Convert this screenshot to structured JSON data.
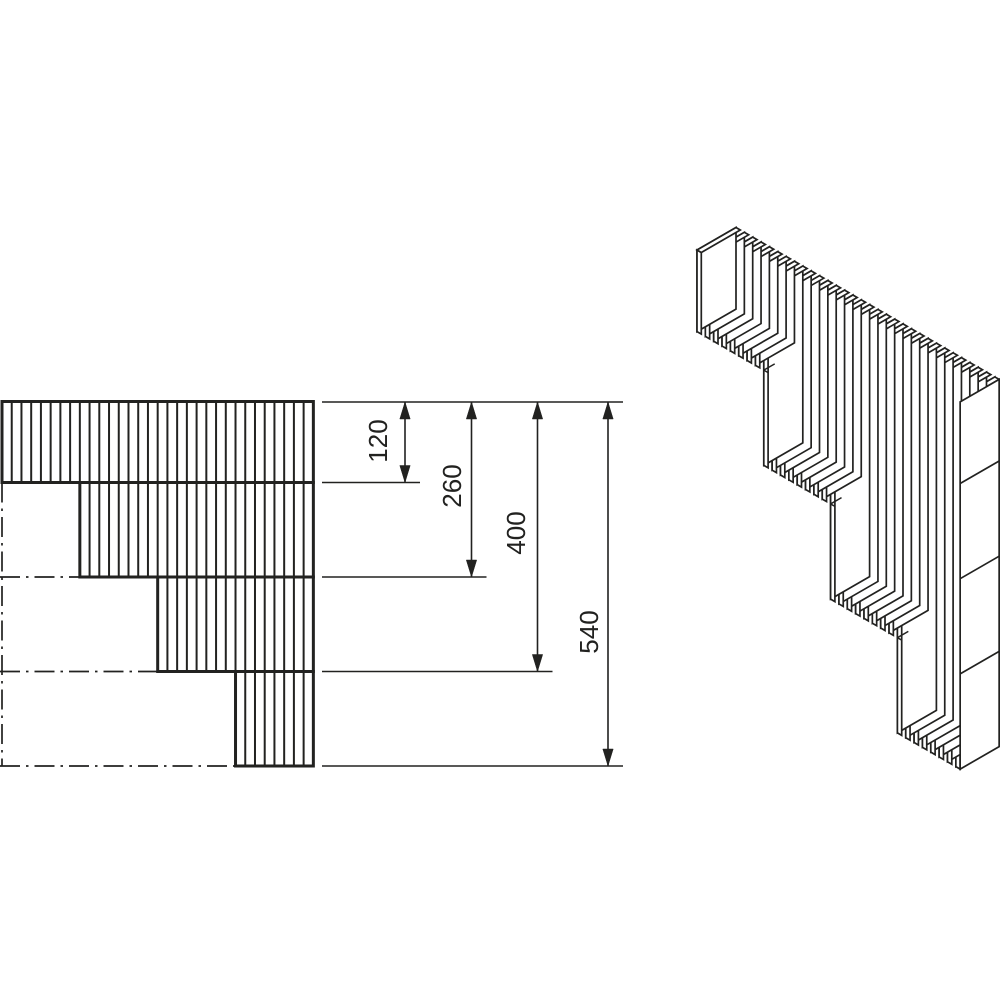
{
  "title": "stepped-block-wall-technical-drawing",
  "colors": {
    "background": "#ffffff",
    "line": "#222220",
    "face_fill": "#ffffff"
  },
  "front_view": {
    "origin": [
      2,
      401.5
    ],
    "scale": 0.675,
    "hatch_spacing": 9.73,
    "hatch_count": 33,
    "hatch_stroke": 2,
    "border_stroke": 3,
    "courses": [
      {
        "bottom_mm": 120,
        "start_index": 0
      },
      {
        "bottom_mm": 260,
        "start_index": 8
      },
      {
        "bottom_mm": 400,
        "start_index": 16
      },
      {
        "bottom_mm": 540,
        "start_index": 24
      }
    ],
    "centerline": {
      "vertical_x": 2,
      "dash_pattern": "20 6 2.5 6"
    }
  },
  "dimensions": {
    "ref_y": 402,
    "ext_start_x": 322,
    "ext_overhang": 15,
    "line_stroke": 1.6,
    "font_size": 26,
    "arrow": {
      "length": 17,
      "half_width": 5.2
    },
    "items": [
      {
        "label": "120",
        "value": 120,
        "line_x": 405,
        "label_cx": 378,
        "label_cy": 441
      },
      {
        "label": "260",
        "value": 260,
        "line_x": 471.5,
        "label_cx": 452,
        "label_cy": 486
      },
      {
        "label": "400",
        "value": 400,
        "line_x": 537.5,
        "label_cx": 516,
        "label_cy": 533
      },
      {
        "label": "540",
        "value": 540,
        "line_x": 608,
        "label_cx": 589,
        "label_cy": 632
      }
    ]
  },
  "iso_view": {
    "origin": [
      697,
      250
    ],
    "step": [
      8.35,
      4.82
    ],
    "thickness": [
      4.3,
      2.48
    ],
    "depth": [
      39,
      -22.5
    ],
    "scale": 0.68,
    "slats_per_course": 8,
    "course_heights_mm": [
      120,
      260,
      400,
      540
    ],
    "joint_marks_mm": [
      120,
      260,
      400
    ],
    "joint_mark_depth_fraction": 0.28,
    "end_panel_divisions_mm": [
      120,
      260,
      400
    ],
    "stroke": 1.7,
    "mark_stroke": 1.5
  }
}
